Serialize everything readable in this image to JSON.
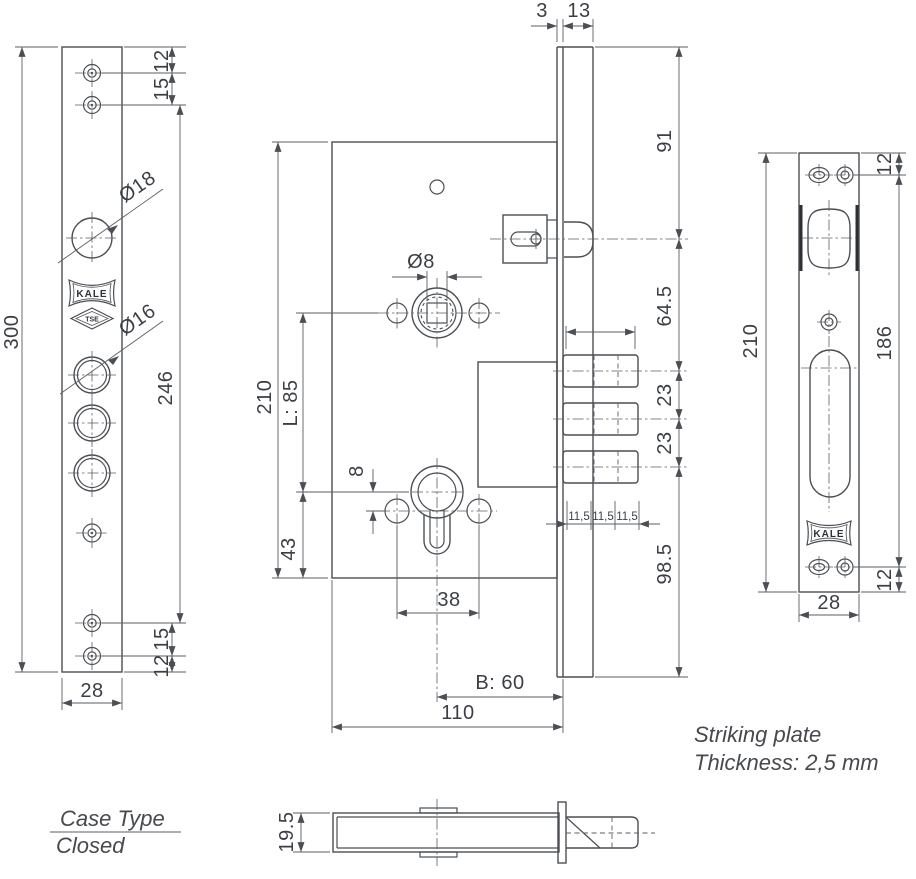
{
  "drawing": {
    "brand": "KALE",
    "tse_mark": "TSE",
    "left_view": {
      "overall_height": "300",
      "top_hole_offset": "12",
      "top_hole_spacing": "15",
      "dia_large": "Ø18",
      "dia_medium": "Ø16",
      "hole_span": "246",
      "bottom_hole_spacing": "15",
      "bottom_hole_offset": "12",
      "width": "28"
    },
    "center_view": {
      "front_gap": "3",
      "faceplate_width": "13",
      "top_to_latch": "91",
      "latch_to_pin": "64.5",
      "pin_spacing_1": "23",
      "pin_spacing_2": "23",
      "pin_to_bottom": "98.5",
      "pin_seg_1": "11,5",
      "pin_seg_2": "11,5",
      "pin_seg_3": "11,5",
      "spindle_dia": "Ø8",
      "case_height": "210",
      "centre_distance": "L: 85",
      "cylinder_to_bottom": "43",
      "cylinder_offset": "8",
      "fixing_hole_span": "38",
      "backset": "B: 60",
      "case_depth": "110"
    },
    "right_view": {
      "overall_height": "210",
      "screw_span": "186",
      "top_offset": "12",
      "bottom_offset": "12",
      "width": "28"
    },
    "bottom_view": {
      "case_thickness": "19.5"
    },
    "notes": {
      "striking_line1": "Striking plate",
      "striking_line2": "Thickness: 2,5 mm",
      "case_type_label": "Case Type",
      "case_type_value": "Closed"
    }
  }
}
